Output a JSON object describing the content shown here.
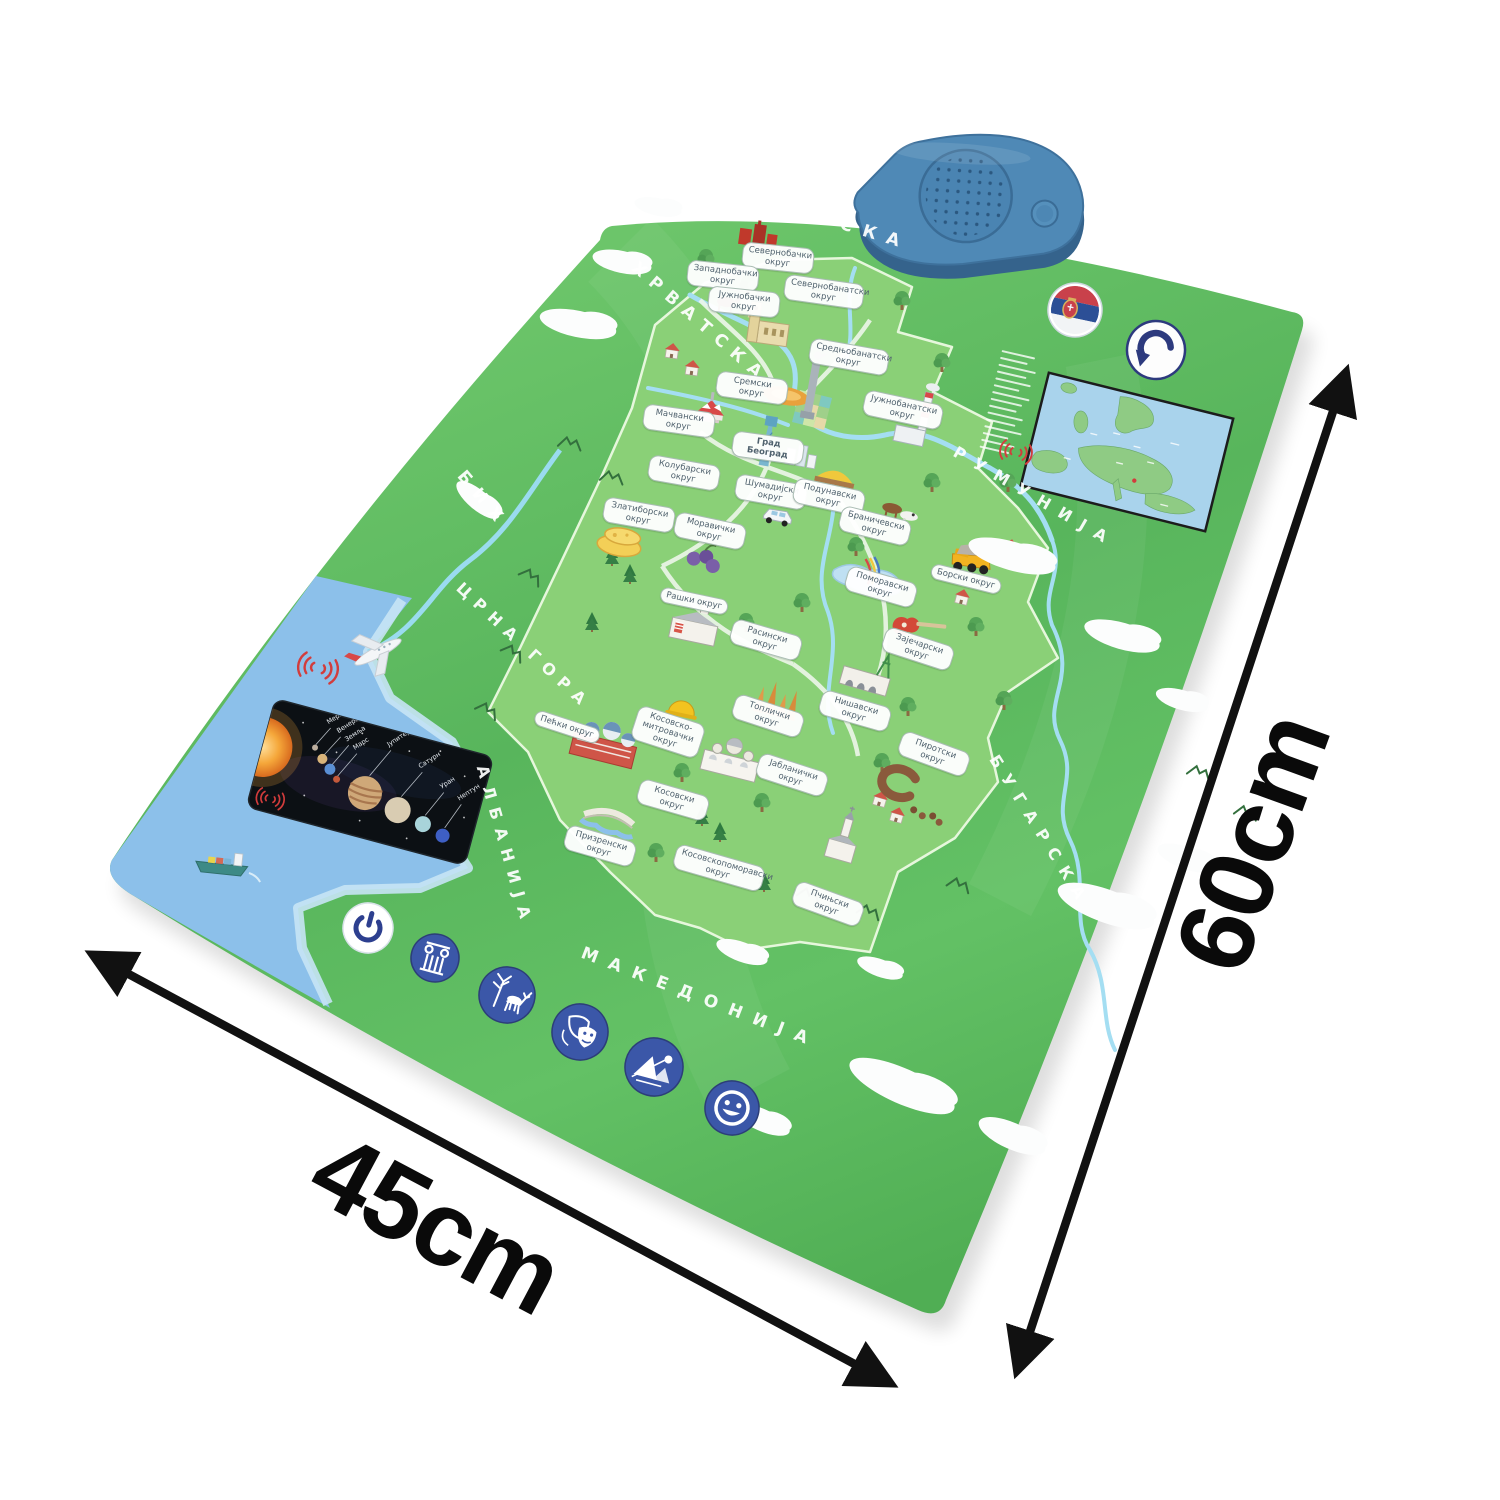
{
  "dimensions": {
    "width_label": "45cm",
    "height_label": "60cm"
  },
  "poster": {
    "countries": {
      "hungary": "МАЂАРСКА",
      "croatia": "ХРВАТСКА",
      "bosnia": "БИХ",
      "montenegro": "ЦРНА ГОРА",
      "albania": "АЛБАНИЈА",
      "macedonia": "МАКЕДОНИЈА",
      "bulgaria": "БУГАРСКА",
      "romania": "РУМУНИЈА"
    },
    "districts": [
      "Севернобачки округ",
      "Западнобачки округ",
      "Севернобанатски округ",
      "Јужнобачки округ",
      "Средњобанатски округ",
      "Сремски округ",
      "Јужнобанатски округ",
      "Мачвански округ",
      "Град Београд",
      "Колубарски округ",
      "Шумадијски округ",
      "Подунавски округ",
      "Браничевски округ",
      "Златиборски округ",
      "Моравички округ",
      "Поморавски округ",
      "Борски округ",
      "Рашки округ",
      "Расински округ",
      "Зајечарски округ",
      "Нишавски округ",
      "Топлички округ",
      "Пиротски округ",
      "Пећки округ",
      "Косовско-митровачки округ",
      "Јабланички округ",
      "Косовски округ",
      "Призренски округ",
      "Косовскопоморавски округ",
      "Пчињски округ"
    ],
    "planets": [
      "Меркур",
      "Венера",
      "Земља",
      "Марс",
      "Јупитер",
      "Сатурн",
      "Уран",
      "Нептун"
    ],
    "touch_icons": [
      "power-icon",
      "column-icon",
      "deer-icon",
      "theater-masks-icon",
      "mountain-icon",
      "smiley-icon"
    ],
    "colors": {
      "poster_green": "#58b55c",
      "serbia_green": "#8ad077",
      "sea_blue": "#8cc0ea",
      "speaker_blue": "#4f89b6",
      "icon_circle_blue": "#3b57a8",
      "flag_red": "#c9414b",
      "flag_blue": "#2c4f96",
      "arrow_black": "#111111",
      "district_label_text": "#50626e"
    }
  }
}
